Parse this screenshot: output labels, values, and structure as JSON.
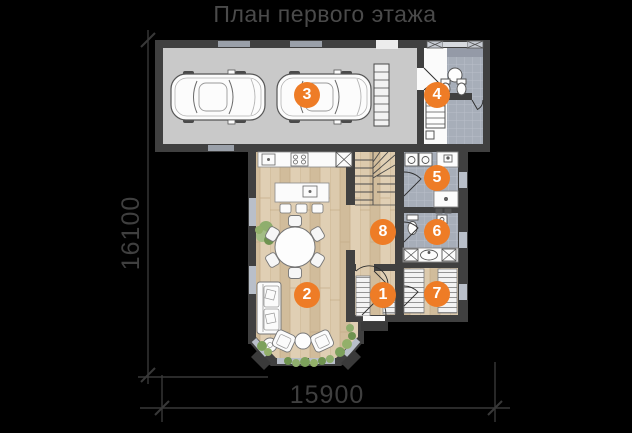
{
  "title": "План первого этажа",
  "dimensions": {
    "height_label": "16100",
    "width_label": "15900"
  },
  "markers": [
    {
      "num": "1"
    },
    {
      "num": "2"
    },
    {
      "num": "3"
    },
    {
      "num": "4"
    },
    {
      "num": "5"
    },
    {
      "num": "6"
    },
    {
      "num": "7"
    },
    {
      "num": "8"
    }
  ],
  "colors": {
    "accent": "#ee7c26",
    "background": "#000000",
    "wall": "#404040",
    "wood_floor": "#d8c5a6",
    "tile_floor": "#a7aeb9",
    "garage_floor": "#c9c9c9",
    "label_text": "#4a4a4a",
    "marker_text": "#ffffff"
  }
}
